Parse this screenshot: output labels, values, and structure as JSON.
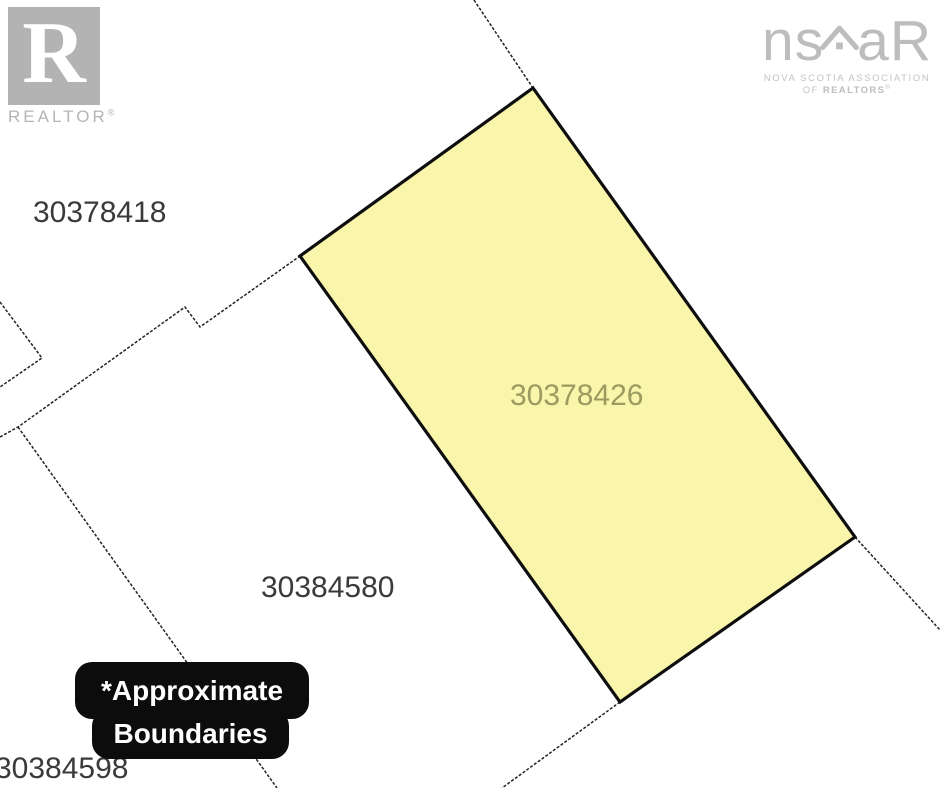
{
  "branding": {
    "realtor_logo": {
      "letter": "R",
      "wordmark": "REALTOR",
      "registered": "®"
    },
    "nsar_logo": {
      "wordmark_left": "ns",
      "wordmark_right": "aR",
      "subtitle_line1": "NOVA SCOTIA ASSOCIATION",
      "subtitle_line2_prefix": "OF ",
      "subtitle_line2_emphasis": "REALTORS",
      "subtitle_line2_registered": "®"
    }
  },
  "map": {
    "parcels": [
      {
        "id": "30378418",
        "highlighted": false
      },
      {
        "id": "30378426",
        "highlighted": true
      },
      {
        "id": "30384580",
        "highlighted": false
      },
      {
        "id": "30384598",
        "highlighted": false
      }
    ],
    "highlight_fill": "#f9f5ab",
    "highlight_label_color": "#9b9b60",
    "boundary_color": "#222222",
    "parcel_outline_color": "#0e0e0e"
  },
  "badge": {
    "line1": "*Approximate",
    "line2": "Boundaries",
    "background": "#0c0c0c",
    "text_color": "#ffffff"
  }
}
